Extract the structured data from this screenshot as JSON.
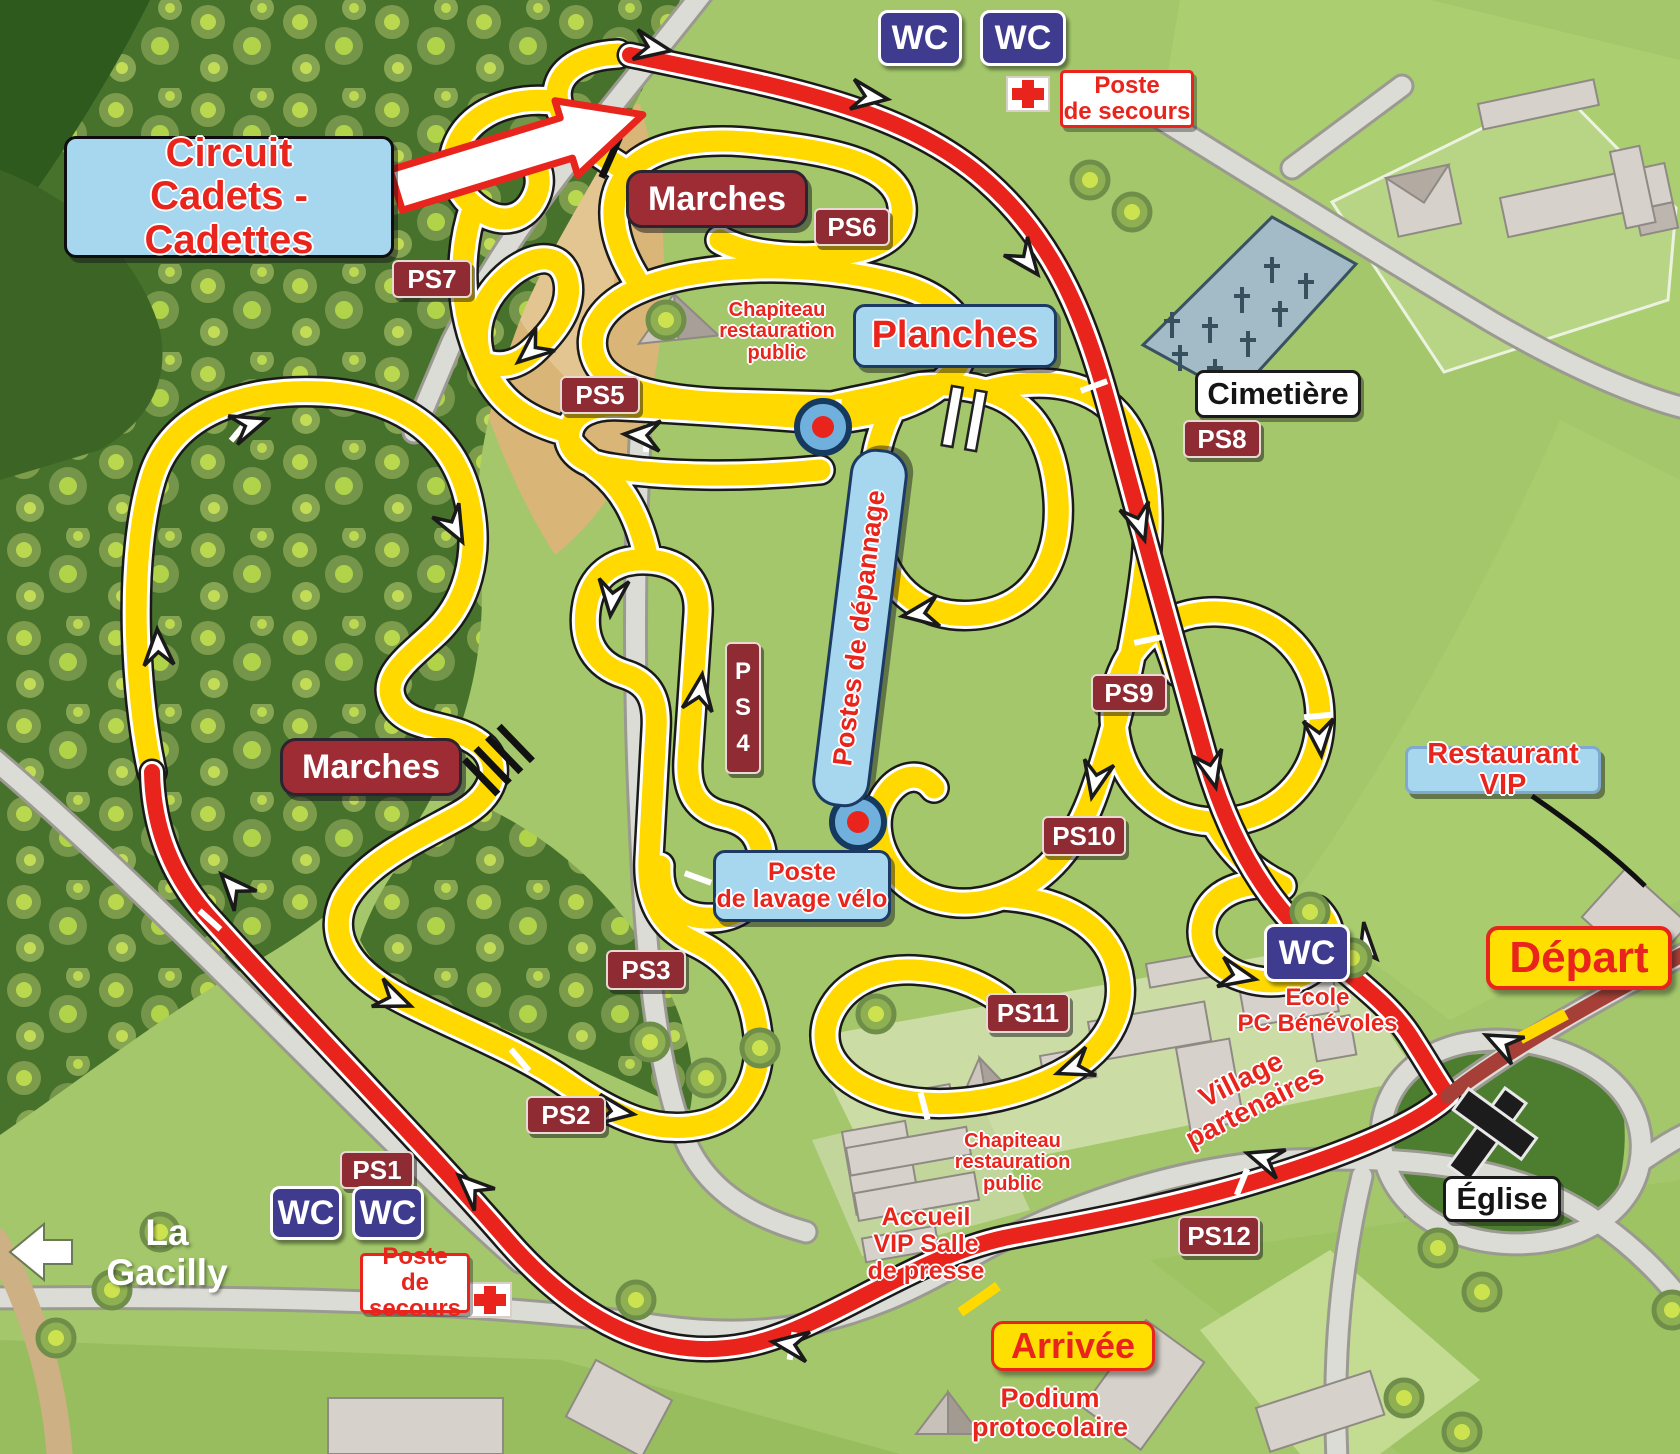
{
  "map_title": "Circuit de cyclo-cross — La Gacilly",
  "labels": {
    "circuit_cadets": "Circuit\nCadets - Cadettes",
    "marches": "Marches",
    "wc": "WC",
    "poste_secours": "Poste\nde secours",
    "chapiteau": "Chapiteau\nrestauration\npublic",
    "planches": "Planches",
    "cimetiere": "Cimetière",
    "postes_depannage": "Postes de dépannage",
    "poste_lavage": "Poste\nde lavage vélo",
    "restaurant_vip": "Restaurant VIP",
    "ecole": "Ecole\nPC Bénévoles",
    "depart": "Départ",
    "arrivee": "Arrivée",
    "village_partenaires": "Village partenaires",
    "accueil": "Accueil\nVIP   Salle\nde presse",
    "podium": "Podium\nprotocolaire",
    "eglise": "Église",
    "la_gacilly": "La Gacilly",
    "ps1": "PS1",
    "ps2": "PS2",
    "ps3": "PS3",
    "ps4_vertical": "P\nS\n4",
    "ps5": "PS5",
    "ps6": "PS6",
    "ps7": "PS7",
    "ps8": "PS8",
    "ps9": "PS9",
    "ps10": "PS10",
    "ps11": "PS11",
    "ps12": "PS12"
  },
  "icons": {
    "first_aid": "white-box-red-cross",
    "direction_arrow": "white-chevron",
    "town_arrow": "white-left-arrow",
    "start_arrow": "white-arrow-red-outline",
    "church": "black-latin-cross",
    "cemetery": "small-cross-markers",
    "bike_pit": "blue-circle-red-dot",
    "stairs": "black-bars",
    "planks": "double-white-bars",
    "start_finish_line": "yellow-bar"
  },
  "colors": {
    "course_offroad_yellow": "#ffd900",
    "course_road_red": "#e8241d",
    "start_road_dark_red": "#a63f37",
    "road_gray": "#dcdcd6",
    "field_green": "#a3c76a",
    "forest_green": "#47722c",
    "sand_tan": "#d9b578",
    "ps_badge": "#8e2b33",
    "wc_badge": "#3f3c90",
    "info_box_blue": "#a7d6ef",
    "start_finish_yellow": "#ffdf00",
    "label_red": "#e8241d"
  }
}
